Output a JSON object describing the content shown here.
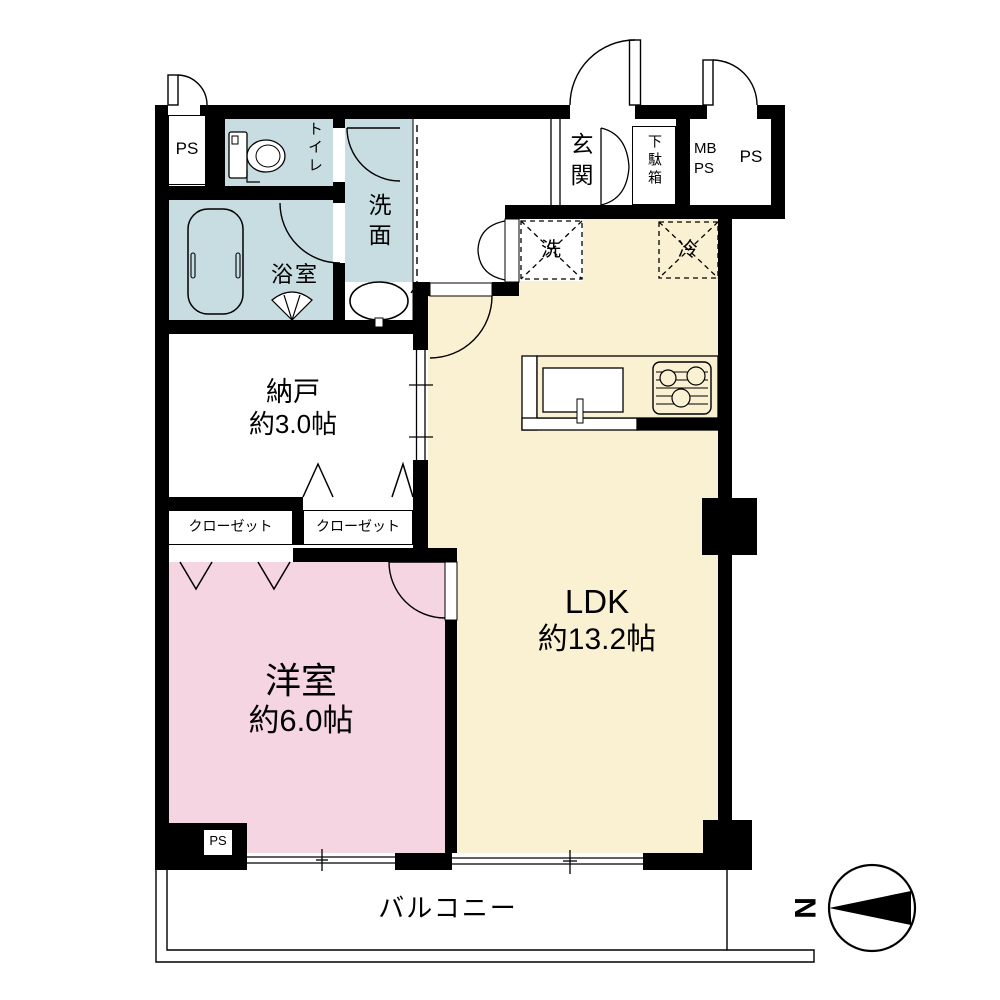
{
  "plan": {
    "rooms": {
      "ldk": {
        "name": "LDK",
        "size": "約13.2帖"
      },
      "bedroom": {
        "name": "洋室",
        "size": "約6.0帖"
      },
      "storage": {
        "name": "納戸",
        "size": "約3.0帖"
      },
      "entrance": {
        "name": "玄関"
      },
      "shoe_box": {
        "name": "下駄箱"
      },
      "toilet": {
        "name": "トイレ"
      },
      "bathroom": {
        "name": "浴室"
      },
      "washroom": {
        "name": "洗面"
      },
      "closet_left": {
        "name": "クローゼット"
      },
      "closet_right": {
        "name": "クローゼット"
      },
      "balcony": {
        "name": "バルコニー"
      }
    },
    "fixtures": {
      "laundry": "洗",
      "fridge": "冷"
    },
    "shafts": {
      "ps_top": "PS",
      "mb_ps": "MB\nPS",
      "ps_right": "PS",
      "ps_bottom": "PS"
    },
    "compass": {
      "north": "N"
    },
    "colors": {
      "wet_area": "#c7dde1",
      "ldk": "#faf0d2",
      "bedroom": "#f5d5e1",
      "wall": "#000000",
      "line": "#000000"
    }
  }
}
